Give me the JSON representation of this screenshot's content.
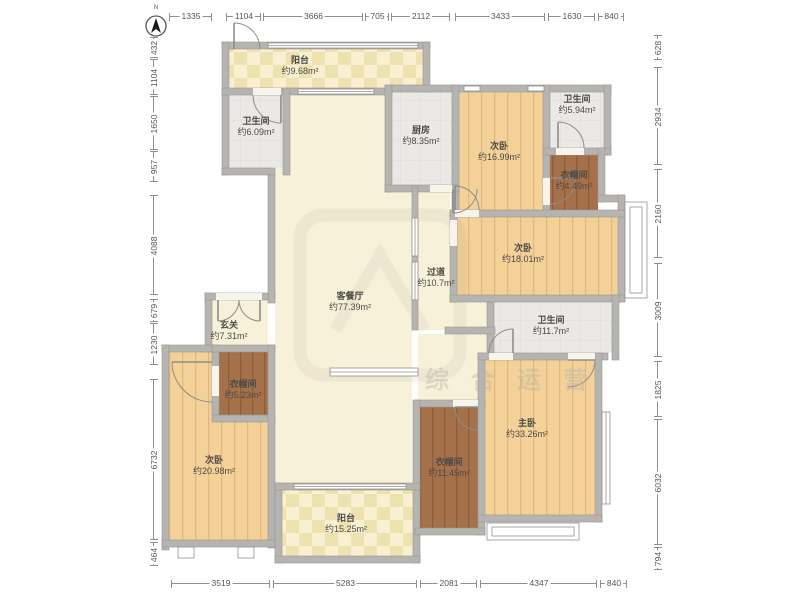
{
  "compass": {
    "label": "N"
  },
  "watermark": {
    "text": "综合运营"
  },
  "rooms": [
    {
      "id": "balcony-top",
      "name": "阳台",
      "area": "约9.68m²",
      "floor": "balcony"
    },
    {
      "id": "bath-left",
      "name": "卫生间",
      "area": "约6.09m²",
      "floor": "tile"
    },
    {
      "id": "kitchen",
      "name": "厨房",
      "area": "约8.35m²",
      "floor": "tile"
    },
    {
      "id": "bedroom-top",
      "name": "次卧",
      "area": "约16.99m²",
      "floor": "wood"
    },
    {
      "id": "bath-top-right",
      "name": "卫生间",
      "area": "约5.94m²",
      "floor": "tile"
    },
    {
      "id": "closet-top-right",
      "name": "衣帽间",
      "area": "约4.49m²",
      "floor": "closet"
    },
    {
      "id": "bedroom-right",
      "name": "次卧",
      "area": "约18.01m²",
      "floor": "wood"
    },
    {
      "id": "corridor",
      "name": "过道",
      "area": "约10.7m²",
      "floor": "cream"
    },
    {
      "id": "living",
      "name": "客餐厅",
      "area": "约77.39m²",
      "floor": "cream"
    },
    {
      "id": "foyer",
      "name": "玄关",
      "area": "约7.31m²",
      "floor": "cream"
    },
    {
      "id": "bath-mid-right",
      "name": "卫生间",
      "area": "约11.7m²",
      "floor": "tile"
    },
    {
      "id": "closet-left",
      "name": "衣帽间",
      "area": "约5.23m²",
      "floor": "closet"
    },
    {
      "id": "bedroom-bottom-left",
      "name": "次卧",
      "area": "约20.98m²",
      "floor": "wood"
    },
    {
      "id": "balcony-bottom",
      "name": "阳台",
      "area": "约15.25m²",
      "floor": "balcony"
    },
    {
      "id": "closet-bottom",
      "name": "衣帽间",
      "area": "约11.45m²",
      "floor": "closet"
    },
    {
      "id": "master-bedroom",
      "name": "主卧",
      "area": "约33.26m²",
      "floor": "wood"
    }
  ],
  "dimensions": {
    "top": [
      "1335",
      "1104",
      "3666",
      "705",
      "2112",
      "3433",
      "1630",
      "840"
    ],
    "bottom": [
      "3519",
      "5283",
      "2081",
      "4347",
      "840"
    ],
    "left": [
      "432",
      "1104",
      "1650",
      "957",
      "4088",
      "679",
      "1230",
      "6732",
      "464"
    ],
    "right": [
      "628",
      "2934",
      "2160",
      "3009",
      "1825",
      "6032",
      "794"
    ]
  },
  "colors": {
    "wall": "#b6b4b0",
    "wood_floor": "#f3d198",
    "tile_floor": "#eae9e5",
    "closet_floor": "#a5714a",
    "cream_floor": "#f8f1d9",
    "balcony_floor": "#f8f0d0",
    "dimension_text": "#55554f",
    "label_text": "#4b4a47"
  }
}
